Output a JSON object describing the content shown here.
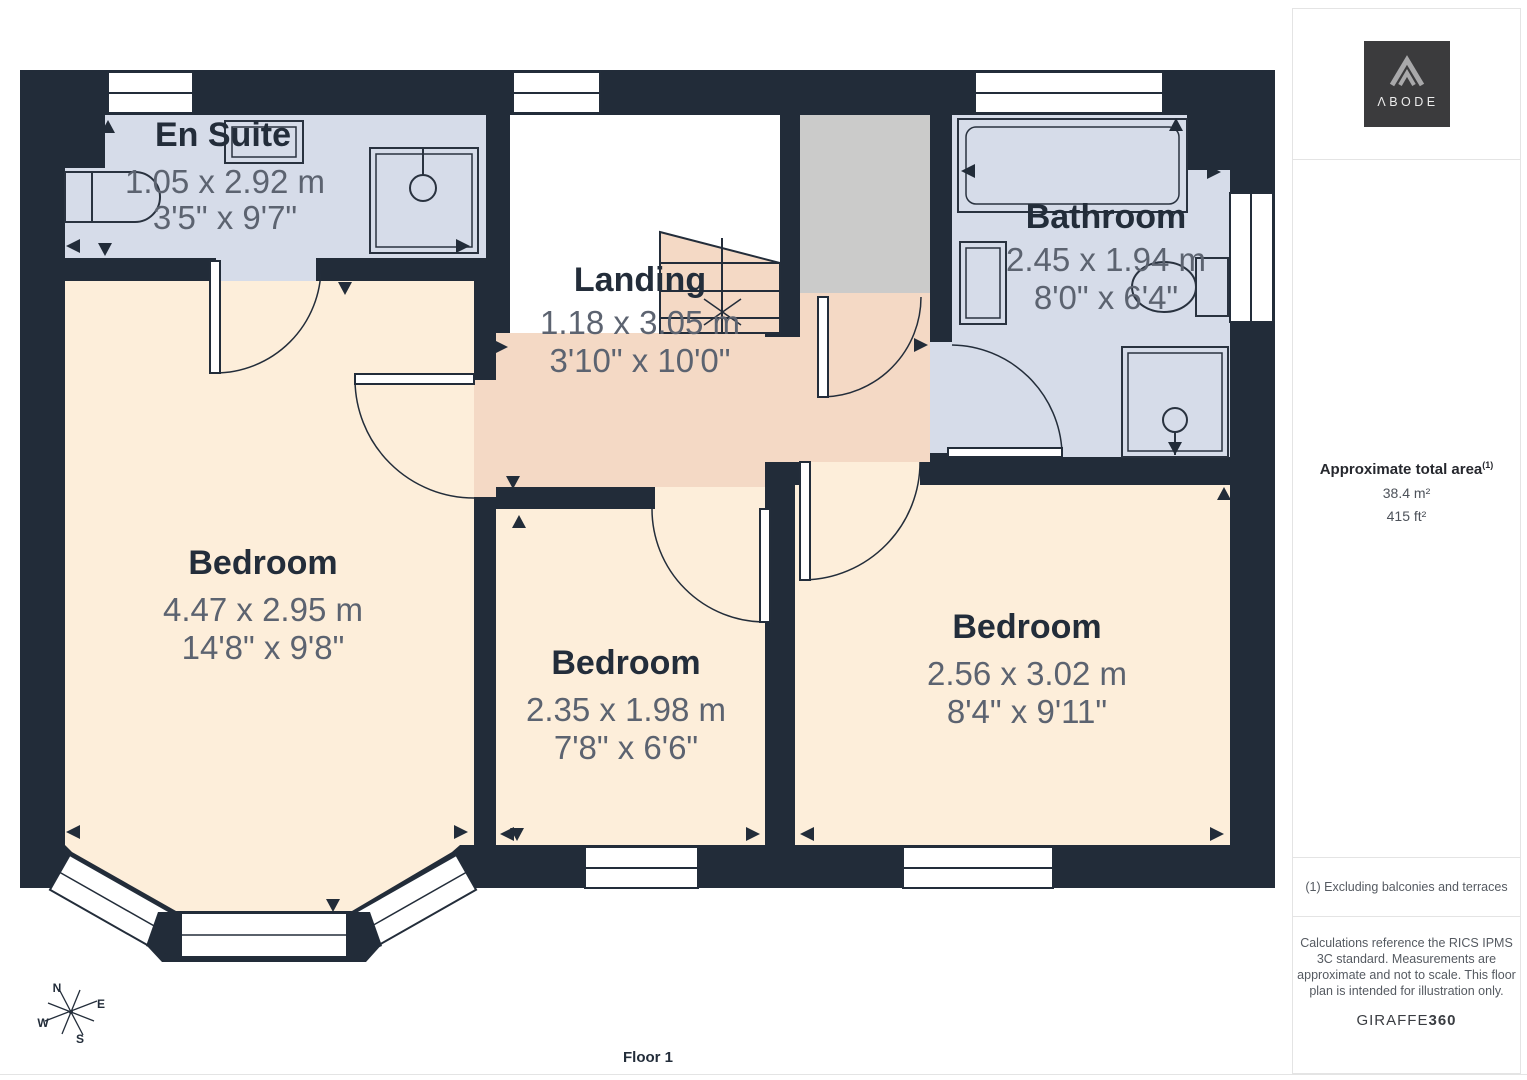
{
  "floorplan": {
    "floor_label": "Floor 1",
    "compass": {
      "n": "N",
      "e": "E",
      "s": "S",
      "w": "W"
    },
    "rooms": [
      {
        "name": "En Suite",
        "metric": "1.05 x 2.92 m",
        "imperial": "3'5\" x 9'7\""
      },
      {
        "name": "Landing",
        "metric": "1.18 x 3.05 m",
        "imperial": "3'10\" x 10'0\""
      },
      {
        "name": "Bathroom",
        "metric": "2.45 x 1.94 m",
        "imperial": "8'0\" x 6'4\""
      },
      {
        "name": "Bedroom",
        "metric": "4.47 x 2.95 m",
        "imperial": "14'8\" x 9'8\""
      },
      {
        "name": "Bedroom",
        "metric": "2.35 x 1.98 m",
        "imperial": "7'8\" x 6'6\""
      },
      {
        "name": "Bedroom",
        "metric": "2.56 x 3.02 m",
        "imperial": "8'4\" x 9'11\""
      }
    ]
  },
  "sidebar": {
    "logo_text": "ΛBODE",
    "area_title": "Approximate total area",
    "area_superscript": "(1)",
    "area_m2": "38.4 m²",
    "area_ft2": "415 ft²",
    "footnote": "(1) Excluding balconies and terraces",
    "disclaimer": "Calculations reference the RICS IPMS 3C standard. Measurements are approximate and not to scale. This floor plan is intended for illustration only.",
    "brand": "GIRAFFE",
    "brand_suffix": "360"
  },
  "colors": {
    "wall": "#222c39",
    "bedroom_floor": "#fdeeda",
    "hallway_floor": "#f4d9c5",
    "wet_room_floor": "#d6dce9",
    "cupboard_floor": "#cbcbca",
    "dimension_text": "#5c6370",
    "label_text": "#232d3a",
    "logo_background": "#3b3b3d"
  }
}
